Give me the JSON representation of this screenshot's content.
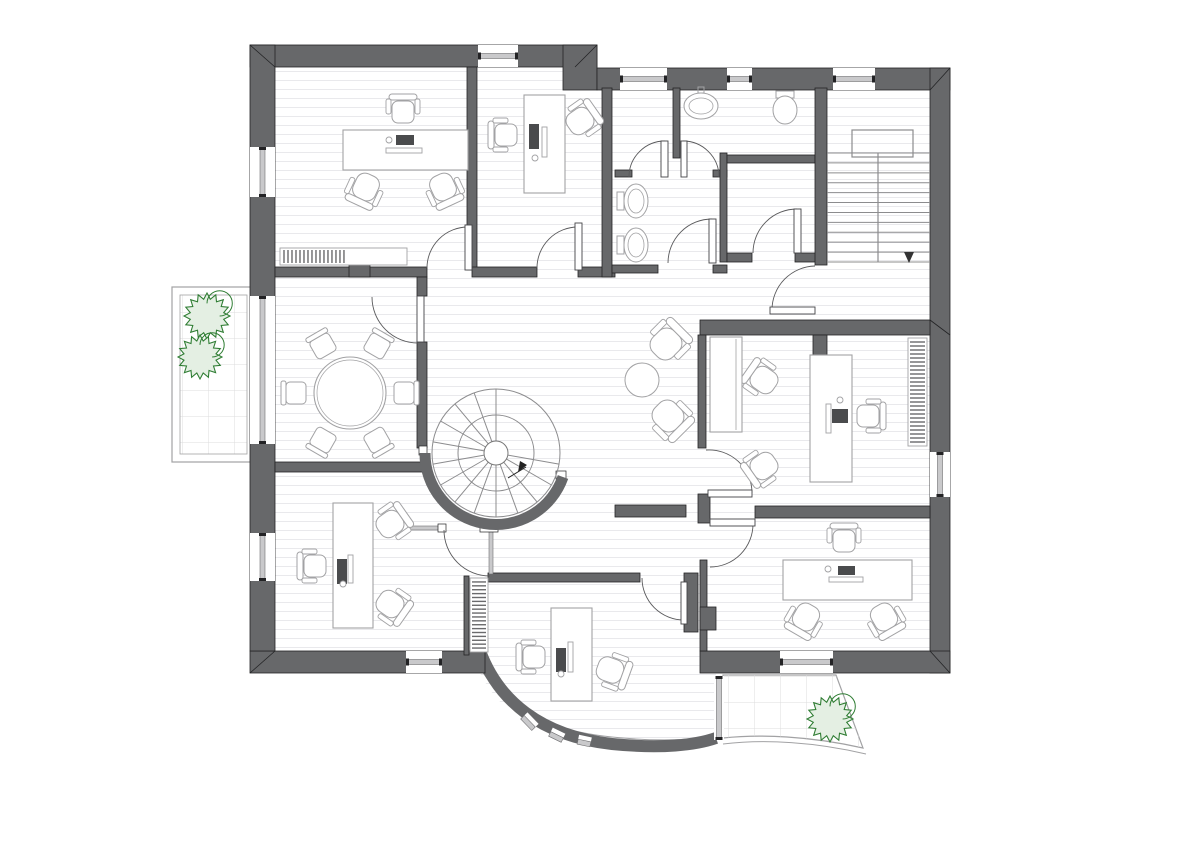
{
  "title": "Office building upper floor plan with furniture, sanitary rooms, spiral staircase and terraces",
  "colors": {
    "wall": "#67686a",
    "wall_edge": "#232325",
    "floor_line": "#e9e9ec",
    "tile_line": "#dcdcde",
    "furniture": "#a2a2a4",
    "furniture_dark": "#4a4b4d",
    "door_arc": "#5a5a5c",
    "stair_line": "#8c8c8e",
    "glass": "#c9c9cb",
    "glass_edge": "#6e6e70",
    "plant_stroke": "#2f7d33",
    "plant_fill": "#e4efe3",
    "white": "#ffffff"
  },
  "rooms": [
    {
      "id": "executive-office-nw"
    },
    {
      "id": "office-n"
    },
    {
      "id": "wc-washroom"
    },
    {
      "id": "wc-lavatory"
    },
    {
      "id": "wc-vestibule"
    },
    {
      "id": "staircase"
    },
    {
      "id": "hallway"
    },
    {
      "id": "meeting-room"
    },
    {
      "id": "office-e"
    },
    {
      "id": "office-se"
    },
    {
      "id": "office-sw"
    },
    {
      "id": "office-s"
    },
    {
      "id": "balcony-west"
    },
    {
      "id": "terrace-south"
    }
  ],
  "plan": {
    "canvas": {
      "w": 1200,
      "h": 848
    },
    "floor_main": [
      275,
      67,
      655,
      584
    ],
    "floor_annex": "M472,651 L716,651 L716,738 C662,745 540,736 498,700 C485,685 476,668 472,651 Z",
    "walls": [
      [
        250,
        45,
        347,
        22
      ],
      [
        563,
        45,
        34,
        45
      ],
      [
        597,
        68,
        353,
        22
      ],
      [
        930,
        68,
        20,
        605
      ],
      [
        700,
        651,
        250,
        22
      ],
      [
        250,
        651,
        235,
        22
      ],
      [
        250,
        45,
        25,
        606
      ],
      [
        467,
        67,
        10,
        203
      ],
      [
        275,
        267,
        152,
        10
      ],
      [
        349,
        258,
        21,
        19
      ],
      [
        472,
        267,
        65,
        10
      ],
      [
        578,
        267,
        37,
        10
      ],
      [
        602,
        88,
        10,
        189
      ],
      [
        673,
        88,
        7,
        70
      ],
      [
        615,
        170,
        17,
        7
      ],
      [
        713,
        170,
        14,
        7
      ],
      [
        720,
        153,
        7,
        109
      ],
      [
        727,
        155,
        88,
        8
      ],
      [
        612,
        265,
        46,
        8
      ],
      [
        713,
        265,
        14,
        8
      ],
      [
        727,
        253,
        25,
        9
      ],
      [
        795,
        253,
        30,
        9
      ],
      [
        815,
        88,
        12,
        177
      ],
      [
        700,
        320,
        230,
        15
      ],
      [
        813,
        335,
        14,
        20
      ],
      [
        698,
        335,
        8,
        113
      ],
      [
        698,
        494,
        12,
        29
      ],
      [
        615,
        505,
        71,
        12
      ],
      [
        755,
        506,
        175,
        12
      ],
      [
        700,
        560,
        7,
        91
      ],
      [
        700,
        607,
        16,
        23
      ],
      [
        488,
        573,
        152,
        9
      ],
      [
        684,
        573,
        14,
        59
      ],
      [
        464,
        576,
        5,
        79
      ],
      [
        417,
        277,
        10,
        19
      ],
      [
        417,
        342,
        10,
        106
      ],
      [
        275,
        462,
        148,
        10
      ]
    ],
    "thin_walls": [
      [
        408,
        526,
        36,
        4
      ],
      [
        489,
        531,
        4,
        43
      ]
    ],
    "caps": [
      [
        438,
        524,
        8,
        8
      ],
      [
        480,
        524,
        18,
        8
      ],
      [
        419,
        446,
        8,
        9
      ],
      [
        556,
        471,
        10,
        8
      ]
    ],
    "bevels": [
      [
        250,
        45,
        275,
        67
      ],
      [
        950,
        68,
        930,
        90
      ],
      [
        950,
        673,
        930,
        651
      ],
      [
        250,
        673,
        275,
        651
      ],
      [
        597,
        45,
        575,
        67
      ],
      [
        930,
        320,
        950,
        335
      ]
    ],
    "windows": [
      {
        "r": [
          478,
          45,
          40,
          22
        ],
        "o": "h"
      },
      {
        "r": [
          620,
          68,
          47,
          22
        ],
        "o": "h"
      },
      {
        "r": [
          727,
          68,
          25,
          22
        ],
        "o": "h"
      },
      {
        "r": [
          833,
          68,
          42,
          22
        ],
        "o": "h"
      },
      {
        "r": [
          250,
          147,
          25,
          50
        ],
        "o": "v"
      },
      {
        "r": [
          250,
          296,
          25,
          148
        ],
        "o": "v"
      },
      {
        "r": [
          250,
          533,
          25,
          48
        ],
        "o": "v"
      },
      {
        "r": [
          406,
          651,
          36,
          22
        ],
        "o": "h"
      },
      {
        "r": [
          780,
          651,
          53,
          22
        ],
        "o": "h"
      },
      {
        "r": [
          930,
          452,
          20,
          45
        ],
        "o": "v"
      },
      {
        "r": [
          714,
          676,
          10,
          64
        ],
        "o": "v"
      }
    ],
    "doors": [
      {
        "leaf": [
          465,
          225,
          7,
          45
        ],
        "arc": "M427,268 A41,41 0 0 1 468,227"
      },
      {
        "leaf": [
          575,
          223,
          7,
          47
        ],
        "arc": "M537,268 A41,41 0 0 1 578,227"
      },
      {
        "leaf": [
          661,
          141,
          7,
          36
        ],
        "arc": "M629,177 A36,36 0 0 1 665,141"
      },
      {
        "leaf": [
          681,
          141,
          6,
          36
        ],
        "arc": "M719,177 A36,36 0 0 0 683,141"
      },
      {
        "leaf": [
          709,
          219,
          7,
          44
        ],
        "arc": "M668,263 A44,44 0 0 1 712,219"
      },
      {
        "leaf": [
          794,
          209,
          7,
          44
        ],
        "arc": "M753,253 A44,44 0 0 1 797,209"
      },
      {
        "leaf": [
          770,
          307,
          45,
          7
        ],
        "arc": "M772,310 A44,44 0 0 1 815,266"
      },
      {
        "leaf": [
          708,
          490,
          44,
          7
        ],
        "arc": "M752,493 A43,43 0 0 0 706,450"
      },
      {
        "leaf": [
          710,
          519,
          45,
          7
        ],
        "arc": "M753,524 A43,43 0 0 1 710,567"
      },
      {
        "leaf": null,
        "arc": "M444,530 A46,46 0 0 0 490,576"
      },
      {
        "leaf": [
          681,
          582,
          6,
          42
        ],
        "arc": "M642,578 A42,42 0 0 0 684,620"
      },
      {
        "leaf": [
          417,
          296,
          7,
          46
        ],
        "arc": "M372,297 A46,46 0 0 0 418,343"
      }
    ],
    "curved_wall": {
      "path": "M480,651 C498,700 540,736 612,744 C662,749 696,745 716,738",
      "inner_edge": "M472,651 C492,702 540,730 612,737 C660,742 696,740 714,735",
      "width": 12,
      "windows": [
        {
          "x": 528,
          "y": 723,
          "len": 16,
          "rot": 46
        },
        {
          "x": 556,
          "y": 737,
          "len": 14,
          "rot": 26
        },
        {
          "x": 584,
          "y": 743,
          "len": 13,
          "rot": 12
        }
      ]
    },
    "spiral_stair": {
      "cx": 496,
      "cy": 453,
      "r_wall": 71,
      "r_out": 64,
      "r_mid": 38,
      "r_hub": 12,
      "wall_arc": "M425,453 A71,71 0 0 0 563,477",
      "tread_angles": [
        10,
        30,
        50,
        70,
        90,
        110,
        130,
        150,
        170,
        190,
        210,
        230,
        250,
        270
      ],
      "arrow_line": [
        508,
        478,
        526,
        467
      ],
      "arrow_head": [
        [
          527,
          465
        ],
        [
          518,
          472
        ],
        [
          520,
          461
        ]
      ]
    },
    "stairs": {
      "x1": 827,
      "x2": 930,
      "y_top": 153,
      "y_bottom": 262,
      "tread_count": 12,
      "rail": [
        852,
        130,
        61,
        27
      ],
      "divider_x": 878,
      "arrow": [
        [
          904,
          252
        ],
        [
          914,
          252
        ],
        [
          909,
          263
        ]
      ]
    },
    "balcony": {
      "outer": [
        172,
        287,
        83,
        175
      ],
      "inner": [
        180,
        295,
        67,
        159
      ]
    },
    "terrace": {
      "path": "M723,675 L836,675 L863,748 C810,736 760,734 723,738 Z",
      "edge2": "M723,744 C765,739 815,742 866,754"
    },
    "plants": [
      {
        "cx": 207,
        "cy": 316,
        "r": 23
      },
      {
        "cx": 200,
        "cy": 357,
        "r": 22
      },
      {
        "cx": 830,
        "cy": 719,
        "r": 23
      }
    ],
    "fixtures": [
      {
        "type": "toilet_h",
        "x": 617,
        "y": 201
      },
      {
        "type": "toilet_h",
        "x": 617,
        "y": 245
      },
      {
        "type": "sink",
        "cx": 701,
        "cy": 106
      },
      {
        "type": "toilet_v",
        "cx": 785,
        "cy": 108
      }
    ],
    "furniture": [
      {
        "type": "desk",
        "r": [
          343,
          130,
          125,
          40
        ]
      },
      {
        "type": "monitor",
        "r": [
          396,
          135,
          18,
          10
        ]
      },
      {
        "type": "dot",
        "c": [
          389,
          140,
          3
        ]
      },
      {
        "type": "bar",
        "r": [
          386,
          148,
          36,
          5
        ]
      },
      {
        "type": "officechair",
        "x": 403,
        "y": 112,
        "rot": 90
      },
      {
        "type": "armchair",
        "x": 366,
        "y": 187,
        "rot": -65
      },
      {
        "type": "armchair",
        "x": 443,
        "y": 187,
        "rot": -115
      },
      {
        "type": "bookshelf",
        "r": [
          280,
          248,
          127,
          17
        ],
        "o": "h",
        "frac": 0.52,
        "n": 16
      },
      {
        "type": "desk",
        "r": [
          524,
          95,
          41,
          98
        ]
      },
      {
        "type": "monitor",
        "r": [
          529,
          124,
          10,
          25
        ]
      },
      {
        "type": "bar",
        "r": [
          542,
          127,
          5,
          30
        ]
      },
      {
        "type": "dot",
        "c": [
          535,
          158,
          3
        ]
      },
      {
        "type": "officechair",
        "x": 506,
        "y": 135,
        "rot": 0
      },
      {
        "type": "armchair",
        "x": 580,
        "y": 121,
        "rot": 145
      },
      {
        "type": "roundtable",
        "cx": 350,
        "cy": 393,
        "r": 36
      },
      {
        "type": "chair",
        "x": 323,
        "y": 346,
        "rot": 60
      },
      {
        "type": "chair",
        "x": 377,
        "y": 346,
        "rot": 120
      },
      {
        "type": "chair",
        "x": 296,
        "y": 393,
        "rot": 0
      },
      {
        "type": "chair",
        "x": 404,
        "y": 393,
        "rot": 180
      },
      {
        "type": "chair",
        "x": 323,
        "y": 440,
        "rot": -60
      },
      {
        "type": "chair",
        "x": 377,
        "y": 440,
        "rot": 240
      },
      {
        "type": "loungechair",
        "x": 666,
        "y": 344,
        "rot": 135
      },
      {
        "type": "loungechair",
        "x": 668,
        "y": 416,
        "rot": 225
      },
      {
        "type": "sidetable",
        "cx": 642,
        "cy": 380,
        "r": 17
      },
      {
        "type": "desk",
        "r": [
          810,
          355,
          42,
          127
        ]
      },
      {
        "type": "monitor",
        "r": [
          832,
          409,
          16,
          14
        ]
      },
      {
        "type": "bar",
        "r": [
          826,
          404,
          5,
          29
        ]
      },
      {
        "type": "dot",
        "c": [
          840,
          400,
          3
        ]
      },
      {
        "type": "officechair",
        "x": 868,
        "y": 416,
        "rot": 180
      },
      {
        "type": "armchair",
        "x": 764,
        "y": 380,
        "rot": 35
      },
      {
        "type": "armchair",
        "x": 764,
        "y": 466,
        "rot": -35
      },
      {
        "type": "bookshelf",
        "r": [
          908,
          338,
          19,
          108
        ],
        "o": "v",
        "frac": 1,
        "n": 26
      },
      {
        "type": "sideboard",
        "r": [
          710,
          337,
          32,
          95
        ]
      },
      {
        "type": "desk",
        "r": [
          783,
          560,
          129,
          40
        ]
      },
      {
        "type": "monitor",
        "r": [
          838,
          566,
          17,
          9
        ]
      },
      {
        "type": "bar",
        "r": [
          829,
          577,
          34,
          5
        ]
      },
      {
        "type": "dot",
        "c": [
          828,
          569,
          3
        ]
      },
      {
        "type": "officechair",
        "x": 844,
        "y": 541,
        "rot": 90
      },
      {
        "type": "armchair",
        "x": 806,
        "y": 617,
        "rot": -60
      },
      {
        "type": "armchair",
        "x": 884,
        "y": 617,
        "rot": -120
      },
      {
        "type": "desk",
        "r": [
          333,
          503,
          40,
          125
        ]
      },
      {
        "type": "monitor",
        "r": [
          337,
          559,
          10,
          25
        ]
      },
      {
        "type": "bar",
        "r": [
          348,
          555,
          5,
          28
        ]
      },
      {
        "type": "dot",
        "c": [
          343,
          584,
          3
        ]
      },
      {
        "type": "officechair",
        "x": 315,
        "y": 566,
        "rot": 0
      },
      {
        "type": "armchair",
        "x": 390,
        "y": 524,
        "rot": 145
      },
      {
        "type": "armchair",
        "x": 390,
        "y": 604,
        "rot": 215
      },
      {
        "type": "desk",
        "r": [
          551,
          608,
          41,
          93
        ]
      },
      {
        "type": "monitor",
        "r": [
          556,
          648,
          10,
          24
        ]
      },
      {
        "type": "bar",
        "r": [
          568,
          642,
          5,
          30
        ]
      },
      {
        "type": "dot",
        "c": [
          561,
          674,
          3
        ]
      },
      {
        "type": "officechair",
        "x": 534,
        "y": 657,
        "rot": 0
      },
      {
        "type": "armchair",
        "x": 610,
        "y": 670,
        "rot": 200
      },
      {
        "type": "bookshelf",
        "r": [
          470,
          578,
          18,
          74
        ],
        "o": "v",
        "frac": 1,
        "n": 18
      }
    ]
  }
}
